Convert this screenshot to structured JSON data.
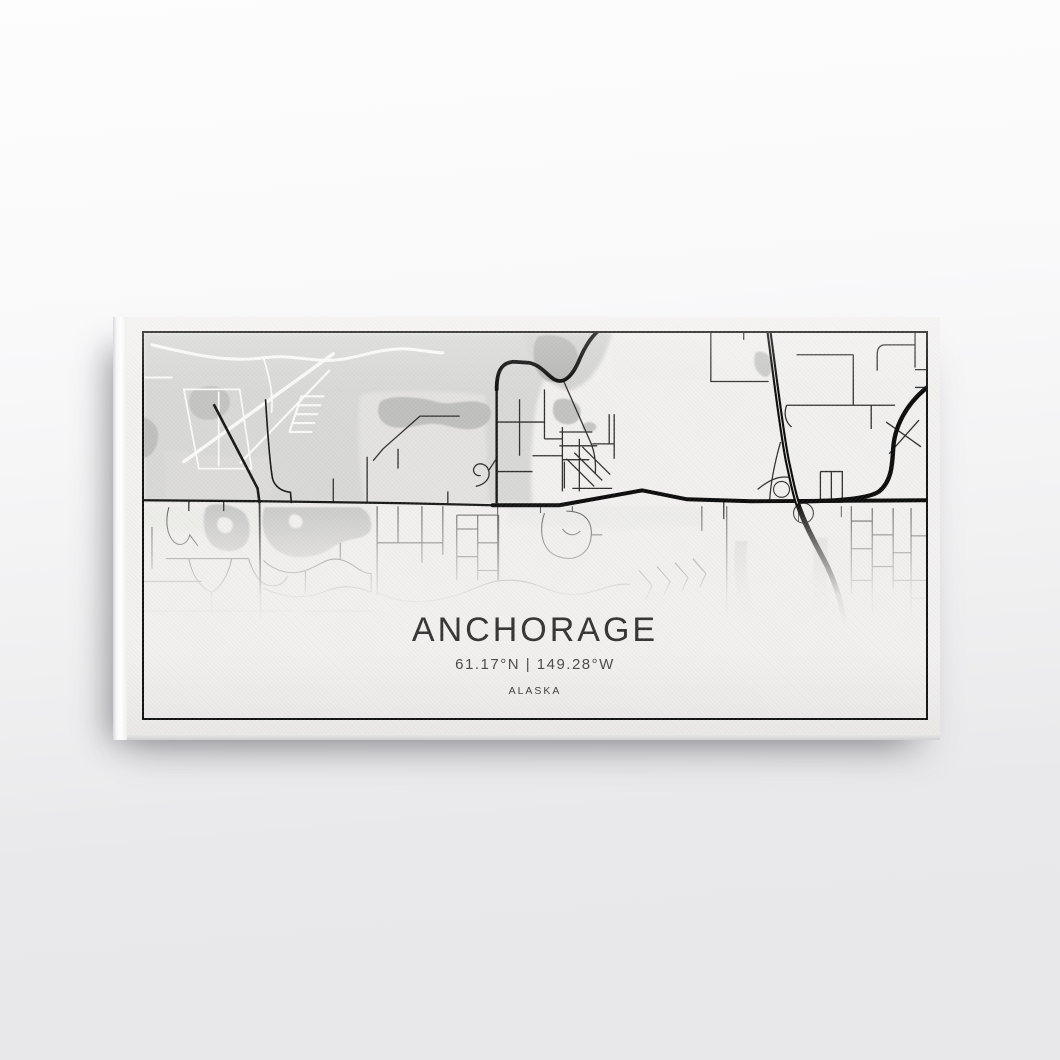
{
  "artwork": {
    "title": "ANCHORAGE",
    "coordinates": "61.17°N | 149.28°W",
    "region": "ALASKA"
  },
  "colors": {
    "wall_top": "#fdfdfd",
    "wall_bottom": "#e8e8ea",
    "canvas_face": "#f2f1ef",
    "frame_border": "#121212",
    "terrain_gray": "#d8d8d7",
    "water_gray": "#b7b7b6",
    "park_gray": "#c8c8c7",
    "runway_white": "#fafaf9",
    "street_dark": "#2e2e2e",
    "street_light": "#565656",
    "road_black": "#0a0a0a",
    "title_text": "#333333",
    "coordinates_text": "#4a4a4a",
    "region_text": "#3d3d3d"
  }
}
